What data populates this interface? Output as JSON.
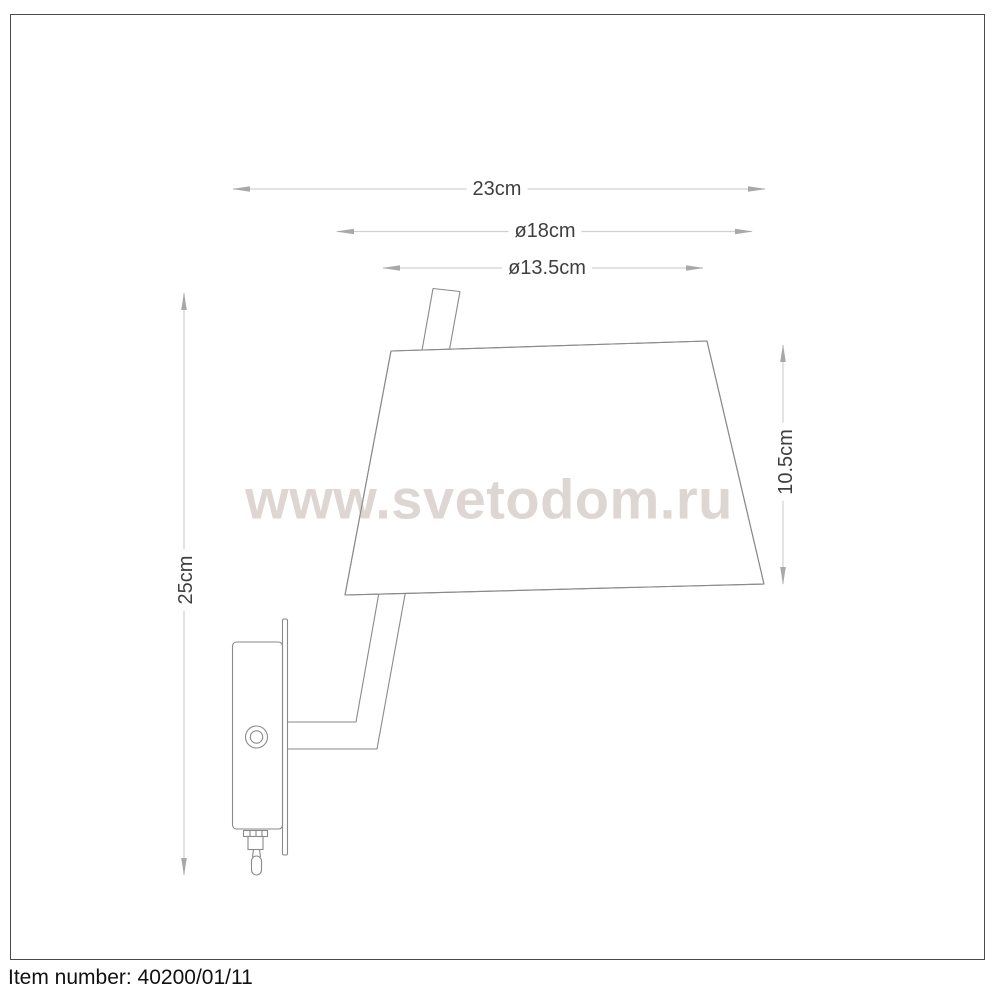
{
  "watermark": {
    "text": "www.svetodom.ru",
    "color": "#ded6d3"
  },
  "dimensions": {
    "total_width": {
      "label": "23cm",
      "orientation": "horizontal"
    },
    "shade_bottom_diameter": {
      "label": "ø18cm",
      "orientation": "horizontal"
    },
    "shade_top_diameter": {
      "label": "ø13.5cm",
      "orientation": "horizontal"
    },
    "total_height": {
      "label": "25cm",
      "orientation": "vertical"
    },
    "shade_height": {
      "label": "10.5cm",
      "orientation": "vertical"
    }
  },
  "footer": {
    "item_number_text": "Item number: 40200/01/11"
  },
  "colors": {
    "drawing_line": "#8a8a8a",
    "dimension_line": "#d0d0d0",
    "arrow": "#a8a8a8",
    "label_text": "#3f3f3f",
    "frame_border": "#4a4a4a"
  }
}
